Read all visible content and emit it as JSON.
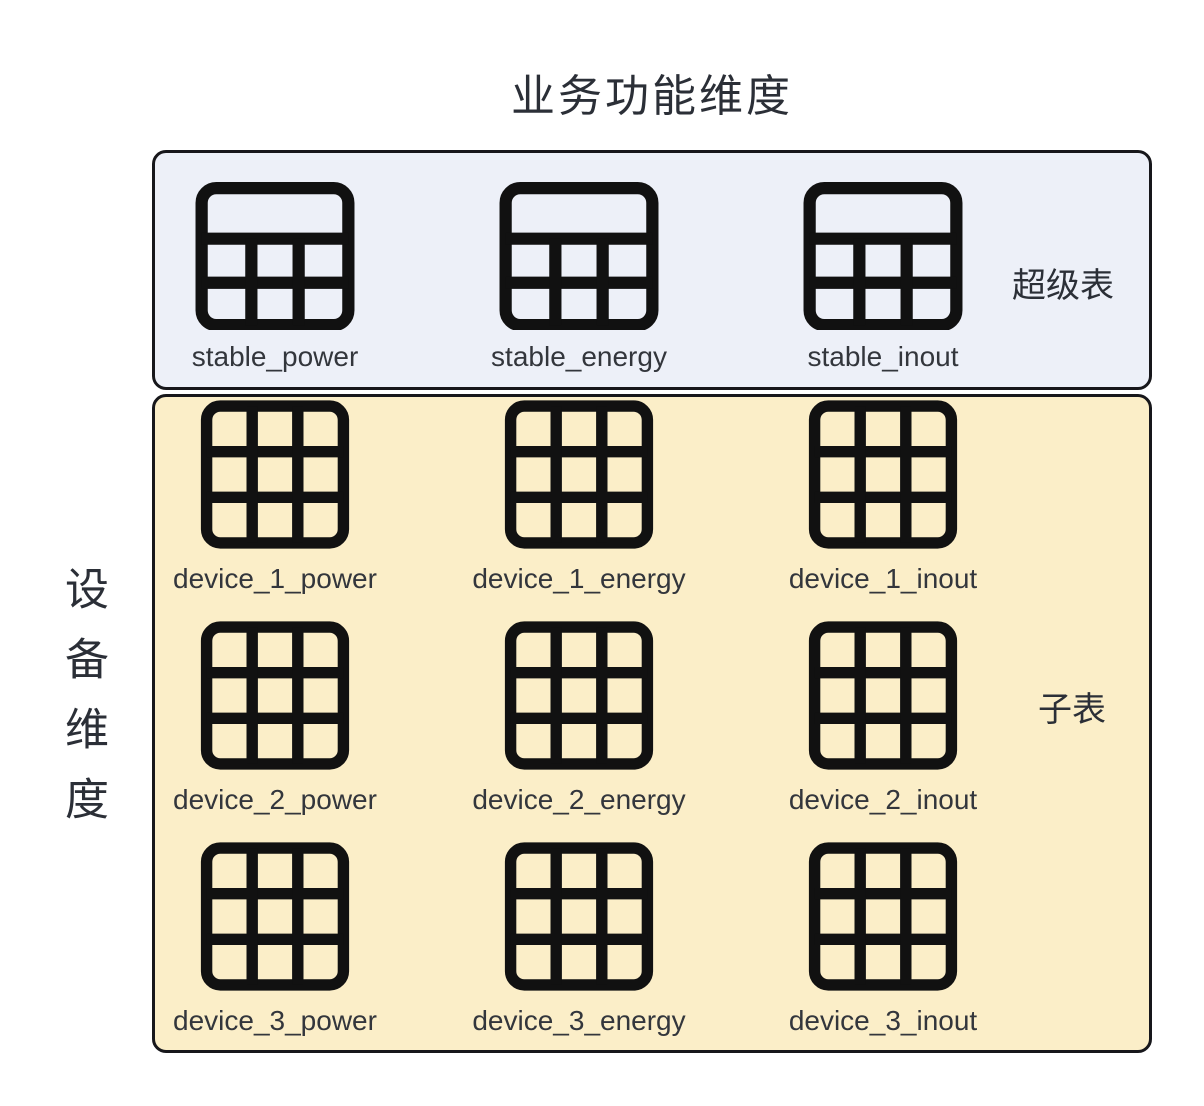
{
  "title": "业务功能维度",
  "side_label": "设备维度",
  "super_panel": {
    "annotation": "超级表",
    "tables": [
      {
        "label": "stable_power"
      },
      {
        "label": "stable_energy"
      },
      {
        "label": "stable_inout"
      }
    ]
  },
  "sub_panel": {
    "annotation": "子表",
    "tables": [
      {
        "label": "device_1_power"
      },
      {
        "label": "device_1_energy"
      },
      {
        "label": "device_1_inout"
      },
      {
        "label": "device_2_power"
      },
      {
        "label": "device_2_energy"
      },
      {
        "label": "device_2_inout"
      },
      {
        "label": "device_3_power"
      },
      {
        "label": "device_3_energy"
      },
      {
        "label": "device_3_inout"
      }
    ]
  },
  "colors": {
    "super_panel_bg": "#edf0f8",
    "sub_panel_bg": "#fbeec8",
    "icon_stroke": "#111111",
    "text": "#2b2f37",
    "panel_border": "#17171b"
  }
}
